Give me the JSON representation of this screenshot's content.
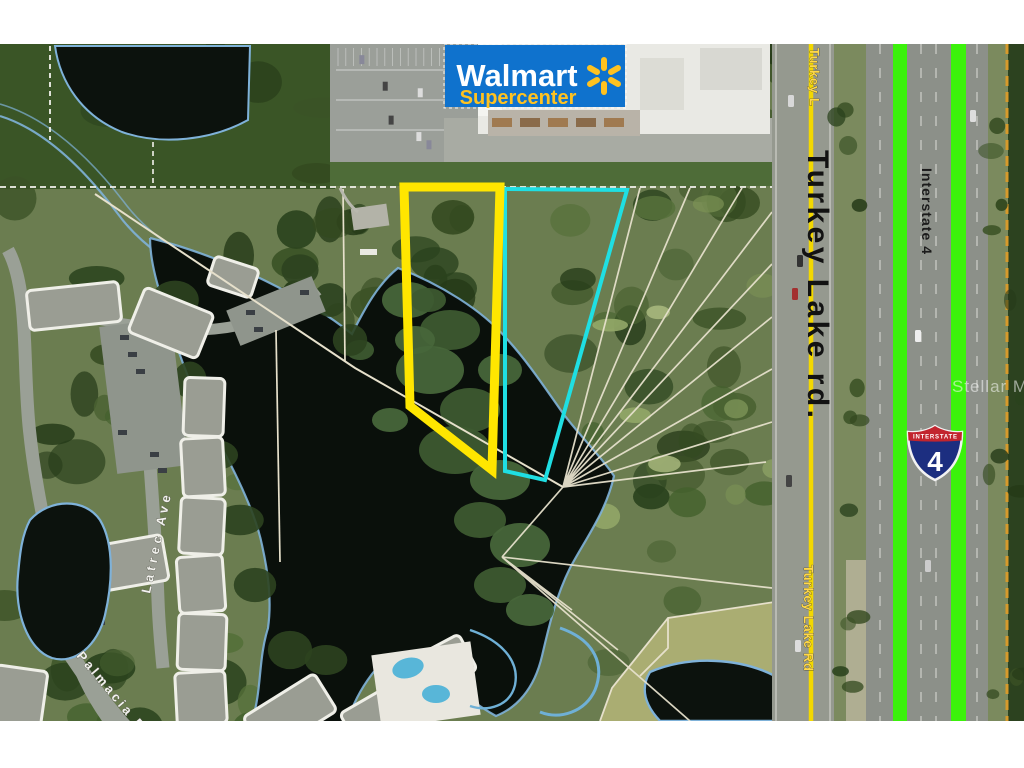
{
  "walmart_sign": {
    "name": "Walmart",
    "sub": "Supercenter",
    "bg_color": "#0f72cd",
    "name_color": "#ffffff",
    "sub_color": "#ffc220",
    "spark_color": "#ffc220"
  },
  "shield": {
    "top": "INTERSTATE",
    "number": "4",
    "red": "#c2252e",
    "blue": "#1c2e80"
  },
  "labels": {
    "turkey_lake_big": "Turkey Lake rd.",
    "interstate": "Interstate 4",
    "turkey_top": "Turkey L",
    "turkey_bottom": "Turkey Lake Rd",
    "latrec": "Latrec Ave",
    "palmacia": "Palmacia Bl"
  },
  "watermark": "Stellar MLS",
  "overlays": {
    "subject_parcel_color": "#ffe600",
    "adjacent_parcel_color": "#1fdfe3",
    "highway_stripe_color": "#3bf20b",
    "road_centerline_color": "#f3d800"
  }
}
